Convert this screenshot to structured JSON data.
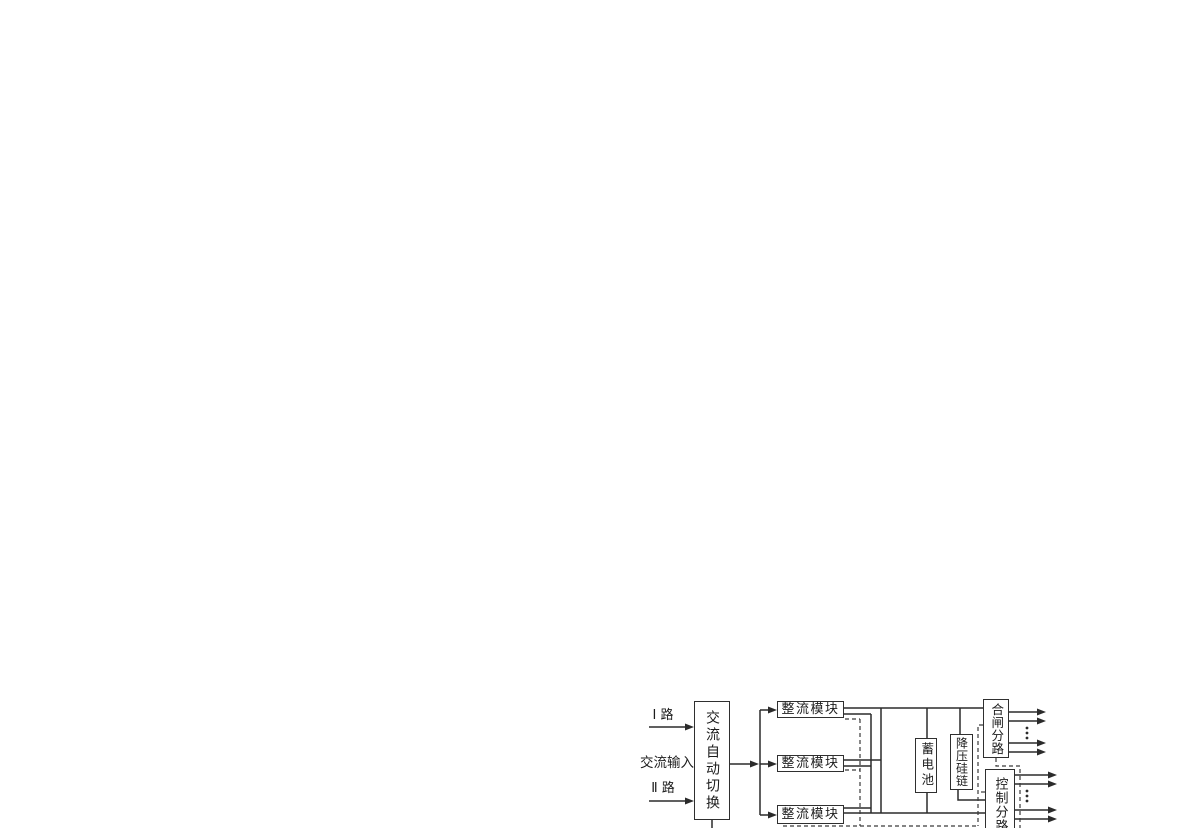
{
  "labels": {
    "route_i": "Ⅰ 路",
    "ac_input": "交流输入",
    "route_ii": "Ⅱ 路"
  },
  "blocks": {
    "ac_auto_switch": "交流自动切换",
    "rectifier_module_1": "整流模块",
    "rectifier_module_2": "整流模块",
    "rectifier_module_3": "整流模块",
    "battery": "蓄电池",
    "voltage_drop_silicon_chain": "降压硅链",
    "closing_branch": "合闸分路",
    "control_branch": "控制分路"
  },
  "colors": {
    "line": "#2b2b2b",
    "dashed_line": "#3a3a3a",
    "text": "#1c1c1c",
    "background": "#ffffff"
  }
}
